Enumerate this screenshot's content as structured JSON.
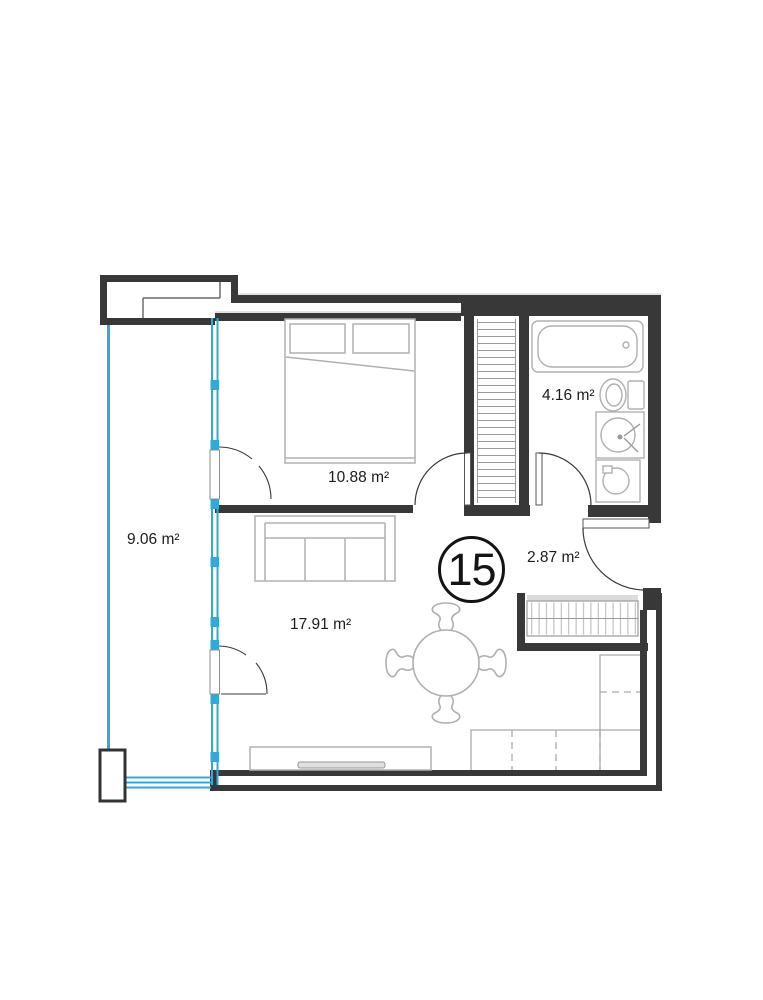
{
  "title": "Apartment floor plan",
  "unit": {
    "number": "15"
  },
  "rooms": {
    "balcony": {
      "label": "9.06 m²"
    },
    "bedroom": {
      "label": "10.88 m²"
    },
    "bathroom": {
      "label": "4.16 m²"
    },
    "hallway": {
      "label": "2.87 m²"
    },
    "living": {
      "label": "17.91 m²"
    }
  },
  "colors": {
    "wall": "#383838",
    "window_accent": "#31a9da",
    "furniture": "#b0b0b0",
    "text": "#1c1c1c"
  }
}
